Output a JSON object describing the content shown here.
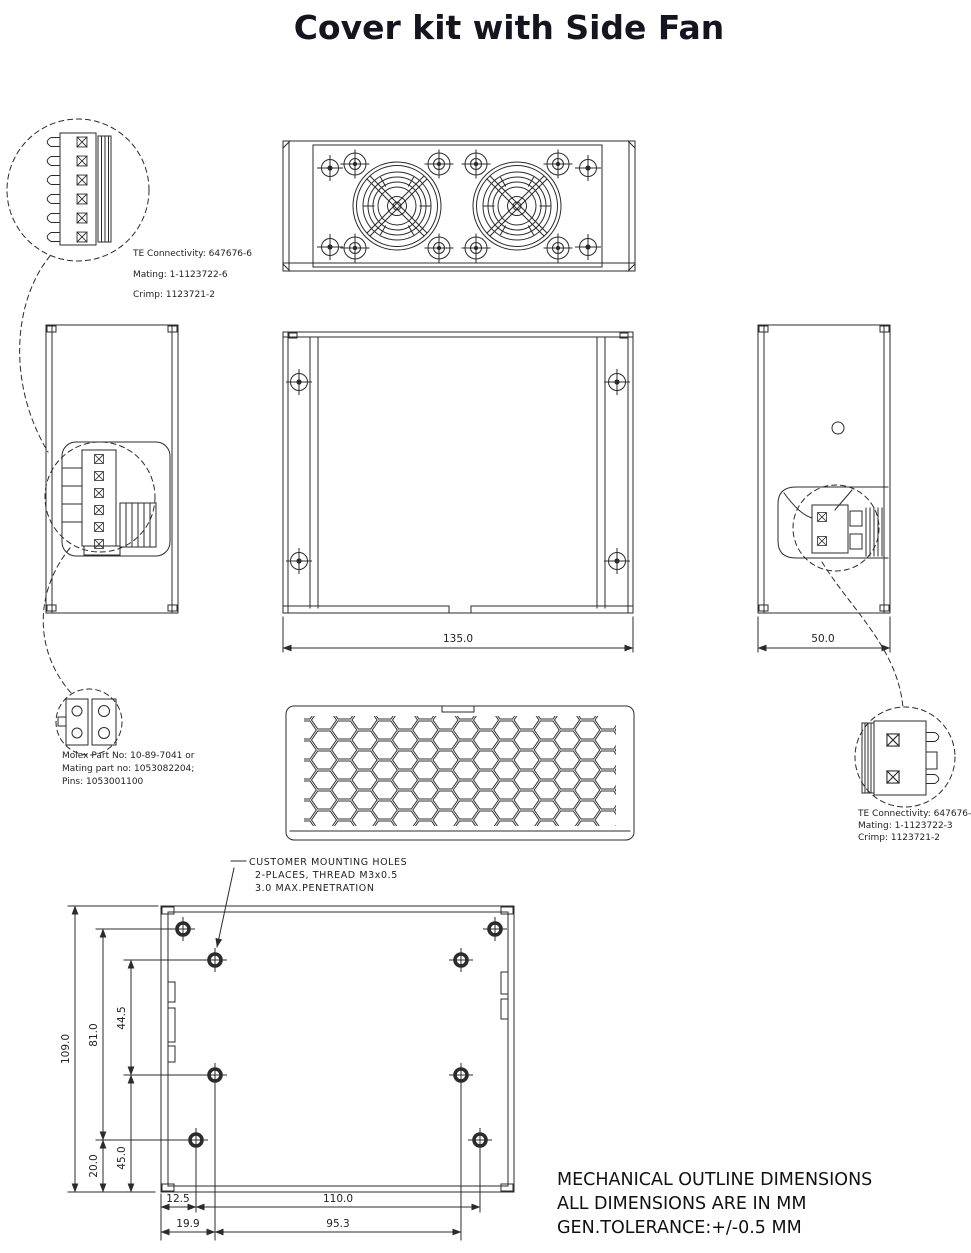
{
  "title": "Cover kit with Side Fan",
  "colors": {
    "line": "#2b2b2b",
    "text": "#1a1a1a",
    "background": "#ffffff"
  },
  "callouts": {
    "input_connector": {
      "line1": "TE Connectivity: 647676-6",
      "line2": "Mating: 1-1123722-6",
      "line3": "Crimp: 1123721-2"
    },
    "aux_connector": {
      "line1": "Molex Part No: 10-89-7041 or",
      "line2": "Mating part no: 1053082204;",
      "line3": "Pins: 1053001100"
    },
    "fan_connector": {
      "line1": "TE Connectivity: 647676-3",
      "line2": "Mating: 1-1123722-3",
      "line3": "Crimp: 1123721-2"
    }
  },
  "dimensions": {
    "front_width": "135.0",
    "side_width": "50.0",
    "overall_height": "109.0",
    "hole_span_vertical": "81.0",
    "inner_span_vertical": "44.5",
    "bottom_offset": "20.0",
    "mid_offset": "45.0",
    "left_hole_offset": "12.5",
    "hole_span_horizontal": "110.0",
    "inner_left_offset": "19.9",
    "inner_span_horizontal": "95.3"
  },
  "notes": {
    "mounting_line1": "CUSTOMER  MOUNTING  HOLES",
    "mounting_line2": "2-PLACES, THREAD M3x0.5",
    "mounting_line3": "3.0  MAX.PENETRATION",
    "general_line1": "MECHANICAL OUTLINE DIMENSIONS",
    "general_line2": "ALL DIMENSIONS ARE IN MM",
    "general_line3": "GEN.TOLERANCE:+/-0.5 MM"
  }
}
